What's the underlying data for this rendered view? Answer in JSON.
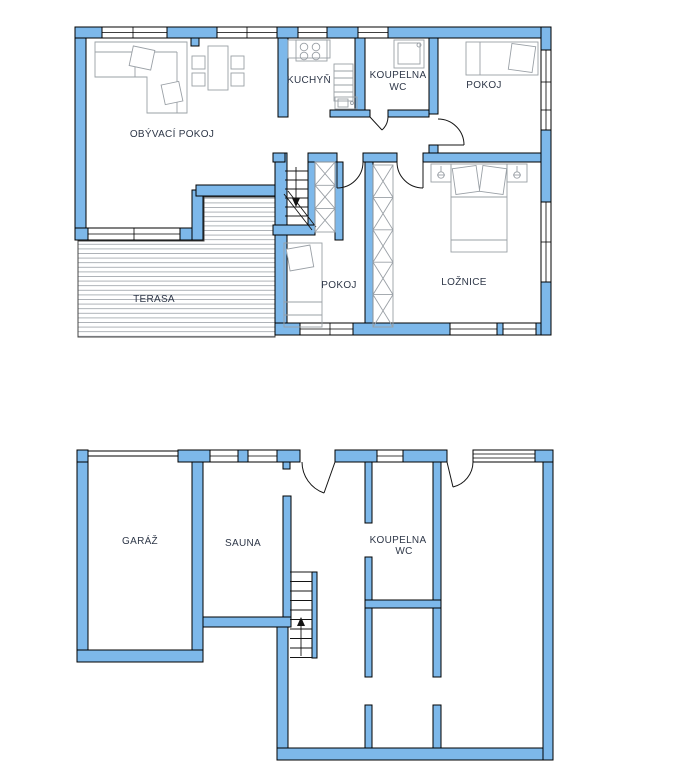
{
  "document": {
    "type": "floor-plan",
    "levels": 2
  },
  "floors": [
    {
      "id": "upper",
      "rooms": [
        {
          "id": "obyvaci-pokoj",
          "label": "OBÝVACÍ POKOJ"
        },
        {
          "id": "kuchyn",
          "label": "KUCHYŇ"
        },
        {
          "id": "koupelna-wc-upper",
          "label": "KOUPELNA",
          "label2": "WC"
        },
        {
          "id": "pokoj-top",
          "label": "POKOJ"
        },
        {
          "id": "pokoj-middle",
          "label": "POKOJ"
        },
        {
          "id": "loznice",
          "label": "LOŽNICE"
        },
        {
          "id": "terasa",
          "label": "TERASA"
        }
      ]
    },
    {
      "id": "lower",
      "rooms": [
        {
          "id": "garaz",
          "label": "GARÁŽ"
        },
        {
          "id": "sauna",
          "label": "SAUNA"
        },
        {
          "id": "koupelna-wc-lower",
          "label": "KOUPELNA",
          "label2": "WC"
        }
      ]
    }
  ],
  "colors": {
    "wall_fill": "#7db8ea",
    "wall_stroke": "#000000",
    "label_color": "#2e3748",
    "furniture_stroke": "#9aa0a6",
    "deck_line": "#9aa0a6",
    "door_stroke": "#141414",
    "window_fill": "#ffffff",
    "background": "#ffffff"
  }
}
